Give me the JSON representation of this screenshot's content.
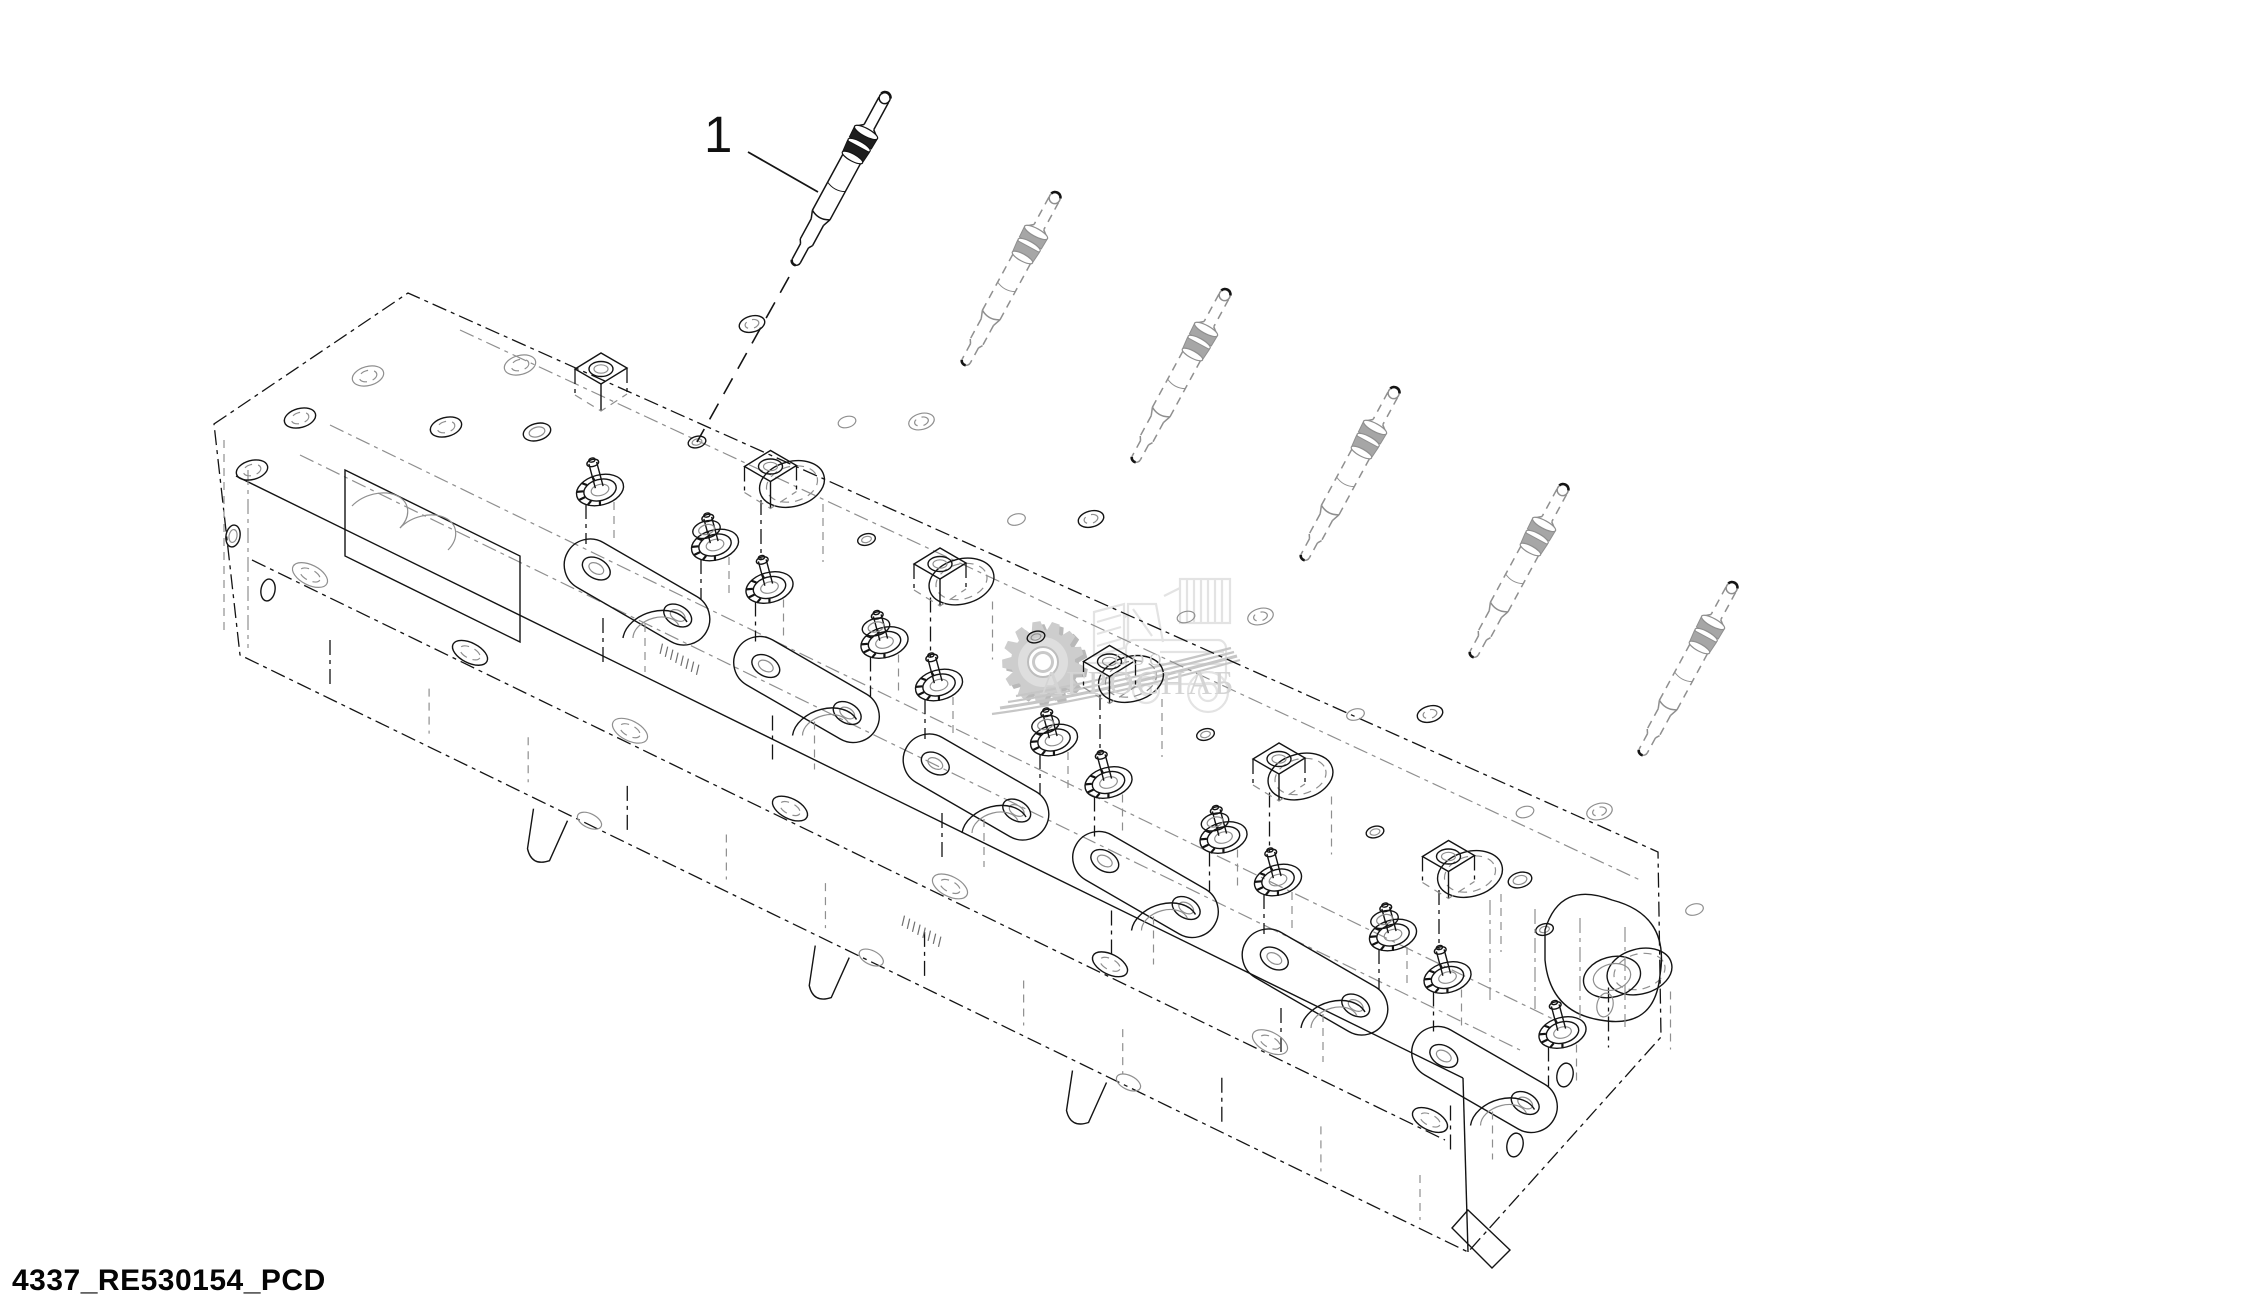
{
  "page": {
    "width": 2245,
    "height": 1311,
    "background": "#ffffff"
  },
  "diagram": {
    "kind": "exploded-parts-line-drawing",
    "subject": "engine cylinder head with glow plugs",
    "line_color": "#141414",
    "hidden_line_color": "#8f8f8f",
    "callout": {
      "label": "1",
      "leader": {
        "x1": 748,
        "y1": 152,
        "x2": 818,
        "y2": 192
      }
    },
    "plug_rotation_deg": 28.5,
    "glow_plugs": [
      {
        "name": "glow-plug-1",
        "style": "solid",
        "tip_x": 888,
        "tip_y": 92
      },
      {
        "name": "glow-plug-2",
        "style": "phantom",
        "tip_x": 1058,
        "tip_y": 192
      },
      {
        "name": "glow-plug-3",
        "style": "phantom",
        "tip_x": 1228,
        "tip_y": 289
      },
      {
        "name": "glow-plug-4",
        "style": "phantom",
        "tip_x": 1397,
        "tip_y": 387
      },
      {
        "name": "glow-plug-5",
        "style": "phantom",
        "tip_x": 1566,
        "tip_y": 484
      },
      {
        "name": "glow-plug-6",
        "style": "phantom",
        "tip_x": 1735,
        "tip_y": 582
      }
    ],
    "assembly_centerline": {
      "x1": 789,
      "y1": 277,
      "x2": 697,
      "y2": 442
    },
    "head": {
      "stations": 6,
      "station_origin_x": 697,
      "station_origin_y": 442,
      "station_pitch_x": 169.5,
      "station_pitch_y": 97.5
    }
  },
  "watermark": {
    "org_type": "ООО",
    "org_name": "АГРОСНАБ",
    "text_color": "#d4d4d4",
    "accent_color": "#c6c6c6",
    "gear_fill": "#cdcdcd",
    "sketch_color": "#e3e3e3",
    "gear_cx": 1043,
    "gear_cy": 662,
    "gear_r": 41
  },
  "footer": {
    "doc_code": "4337_RE530154_PCD"
  }
}
